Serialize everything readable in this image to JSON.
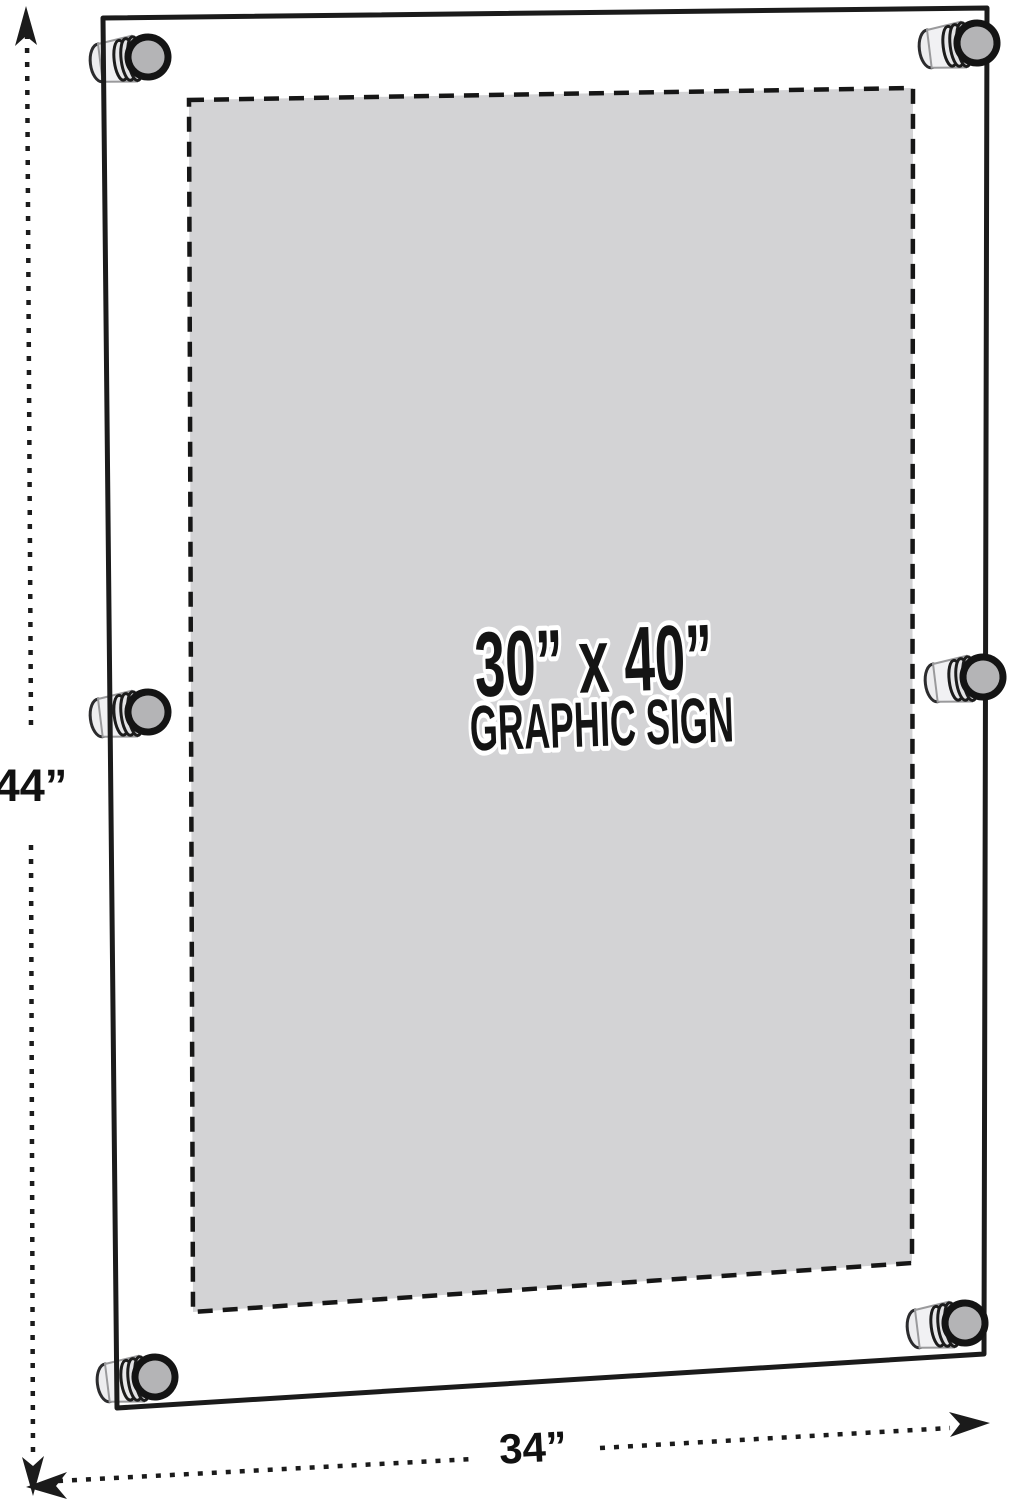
{
  "diagram": {
    "sign": {
      "size_label": "30” x 40”",
      "type_label": "GRAPHIC SIGN"
    },
    "dimensions": {
      "height_label": "44”",
      "width_label": "34”"
    },
    "colors": {
      "outline": "#1b1b1b",
      "graphic_fill": "#d3d3d5",
      "standoff_face_fill": "#b4b4b6",
      "standoff_body_fill": "#f1f1f3",
      "standoff_cap_fill": "#ededef"
    },
    "standoff_positions": [
      "top-left",
      "top-right",
      "middle-left",
      "middle-right",
      "bottom-left",
      "bottom-right"
    ]
  }
}
